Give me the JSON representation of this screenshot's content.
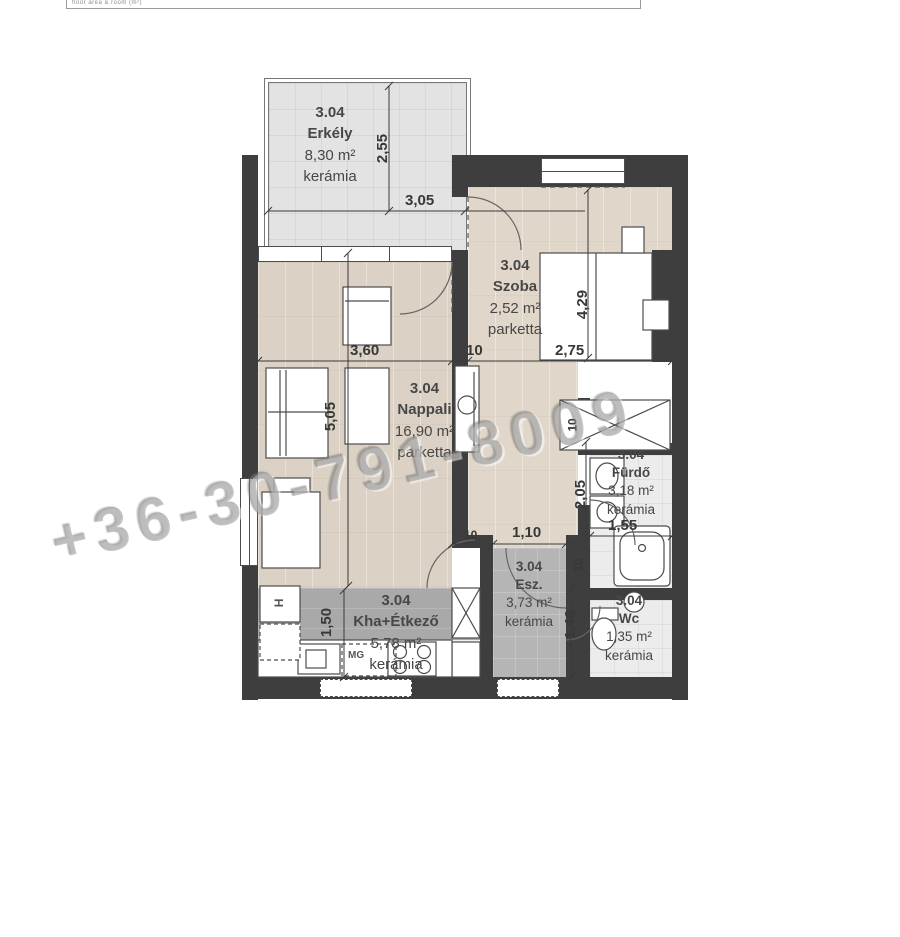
{
  "top_strip": {
    "text": "floor area & room (m²)"
  },
  "watermark": {
    "text": "+36-30-791-8009"
  },
  "rooms": {
    "erkely": {
      "id": "3.04",
      "name": "Erkély",
      "area": "8,30 m²",
      "floor": "kerámia"
    },
    "szoba": {
      "id": "3.04",
      "name": "Szoba",
      "area": "2,52 m²",
      "floor": "parketta"
    },
    "nappali": {
      "id": "3.04",
      "name": "Nappali",
      "area": "16,90 m²",
      "floor": "parketta"
    },
    "kha": {
      "id": "3.04",
      "name": "Kha+Étkező",
      "area": "5,78 m²",
      "floor": "kerámia"
    },
    "esz": {
      "id": "3.04",
      "name": "Esz.",
      "area": "3,73 m²",
      "floor": "kerámia"
    },
    "furdo": {
      "id": "3.04",
      "name": "Fürdő",
      "area": "3,18 m²",
      "floor": "kerámia"
    },
    "wc": {
      "id": "3.04",
      "name": "Wc",
      "area": "1,35 m²",
      "floor": "kerámia"
    }
  },
  "dimensions": {
    "balcony_height": "2,55",
    "balcony_width": "3,05",
    "nappali_width": "3,60",
    "wall_a": "10",
    "szoba_width": "2,75",
    "szoba_height": "4,29",
    "nappali_height": "5,05",
    "kitchen_height": "1,50",
    "wall_b": "10",
    "esz_door": "1,10",
    "furdo_height": "2,05",
    "furdo_width": "1,55",
    "wall_c": "10",
    "wc_height": "1,46",
    "wall_d": "10"
  },
  "labels": {
    "washing_machine": "MG",
    "fridge": "H"
  },
  "colors": {
    "wall": "#3e3e3e",
    "parketta": "#dbd1c4",
    "balcony": "#e3e3e3",
    "kitchen_gray": "#a9a9a9",
    "tile_gray": "#b5b5b5",
    "text": "#474747"
  }
}
